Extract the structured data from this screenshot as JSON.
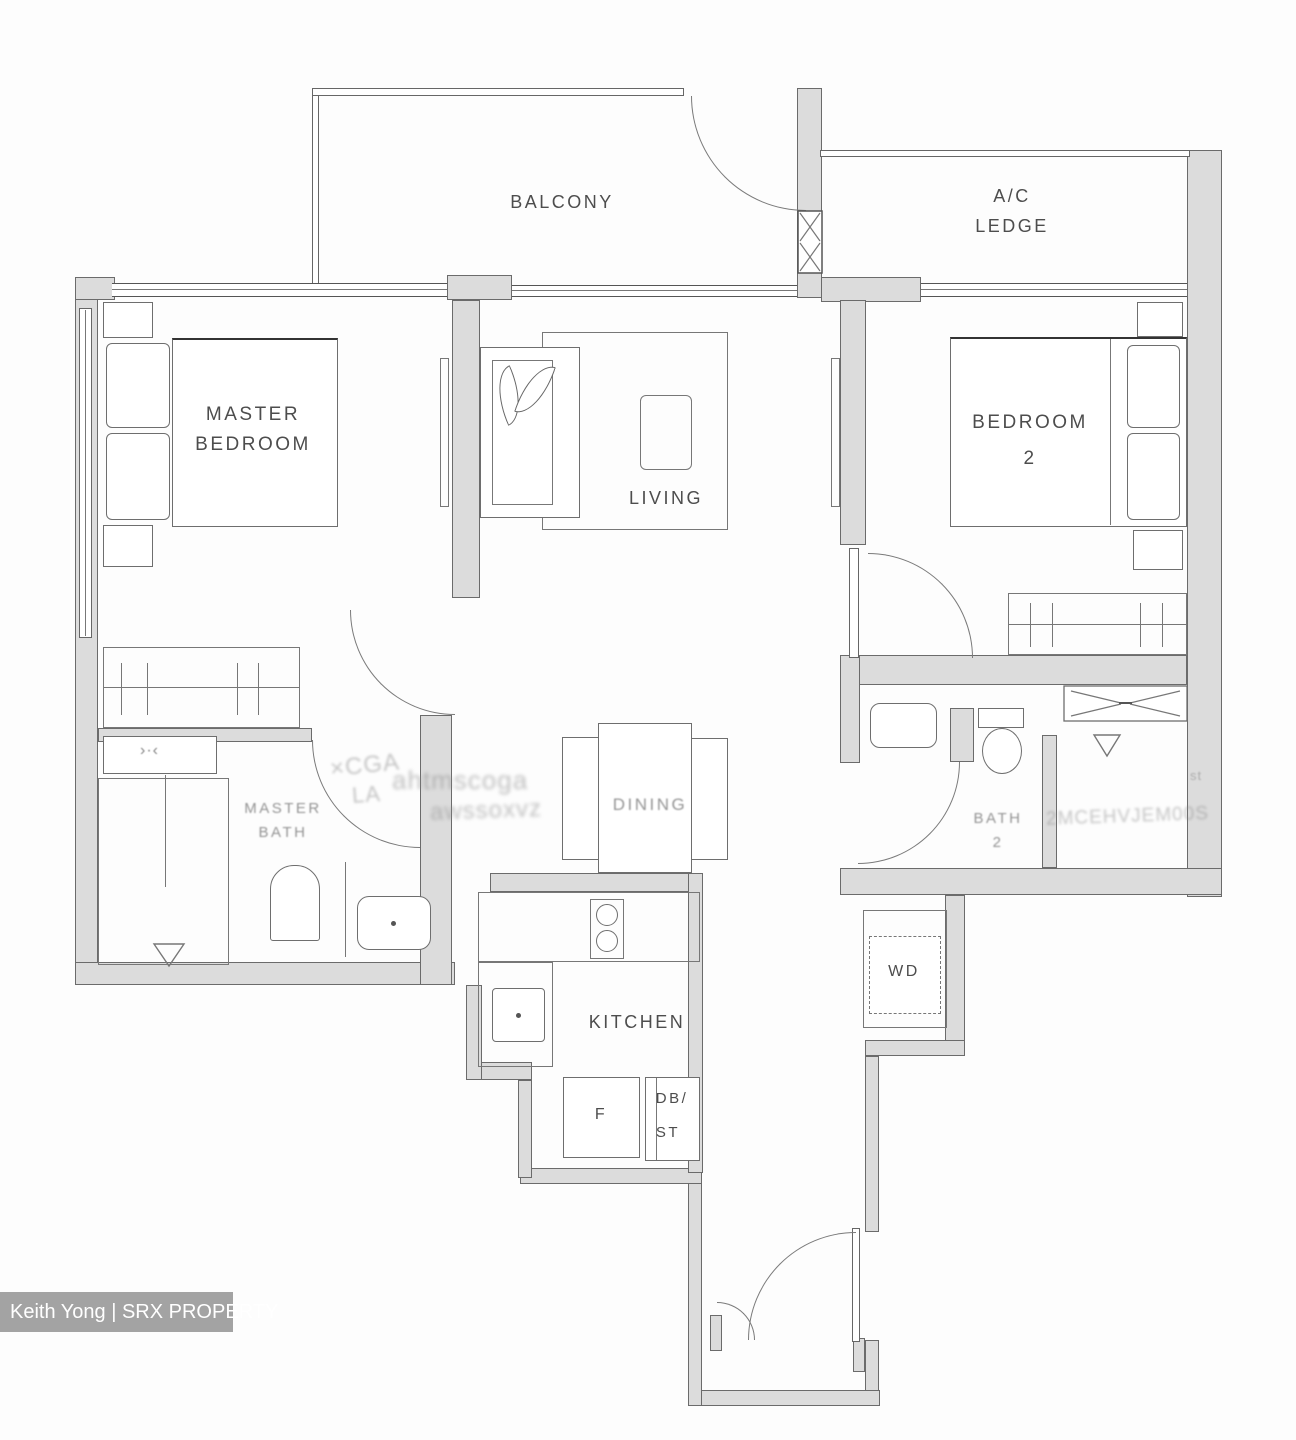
{
  "rooms": {
    "balcony": {
      "label": "BALCONY"
    },
    "ac_ledge": {
      "line1": "A/C",
      "line2": "LEDGE"
    },
    "master_bedroom": {
      "line1": "MASTER",
      "line2": "BEDROOM"
    },
    "living": {
      "label": "LIVING"
    },
    "bedroom2": {
      "line1": "BEDROOM",
      "line2": "2"
    },
    "dining": {
      "label": "DINING",
      "garbled": true
    },
    "master_bath": {
      "line1": "MASTER",
      "line2": "BATH",
      "garbled": true
    },
    "bath2": {
      "line1": "BATH",
      "line2": "2",
      "garbled": true
    },
    "kitchen": {
      "label": "KITCHEN"
    }
  },
  "fixtures": {
    "fridge": "F",
    "db_line1": "DB/",
    "db_line2": "ST",
    "washer_dryer": "WD"
  },
  "watermark": {
    "text": "Keith Yong | SRX PROPERTY",
    "bg": "#a3a3a3",
    "fg": "#ffffff"
  },
  "remnants": {
    "r1": "×CGA",
    "r2": "LA",
    "r3": "ahtmscoga",
    "r4": "awssoxvz",
    "r5": "2MCEHVJEM00S",
    "r6": "st"
  },
  "colors": {
    "wall_fill": "#dcdcdc",
    "wall_edge": "#6b6b6b",
    "line": "#777777",
    "label": "#4d4d4d"
  }
}
